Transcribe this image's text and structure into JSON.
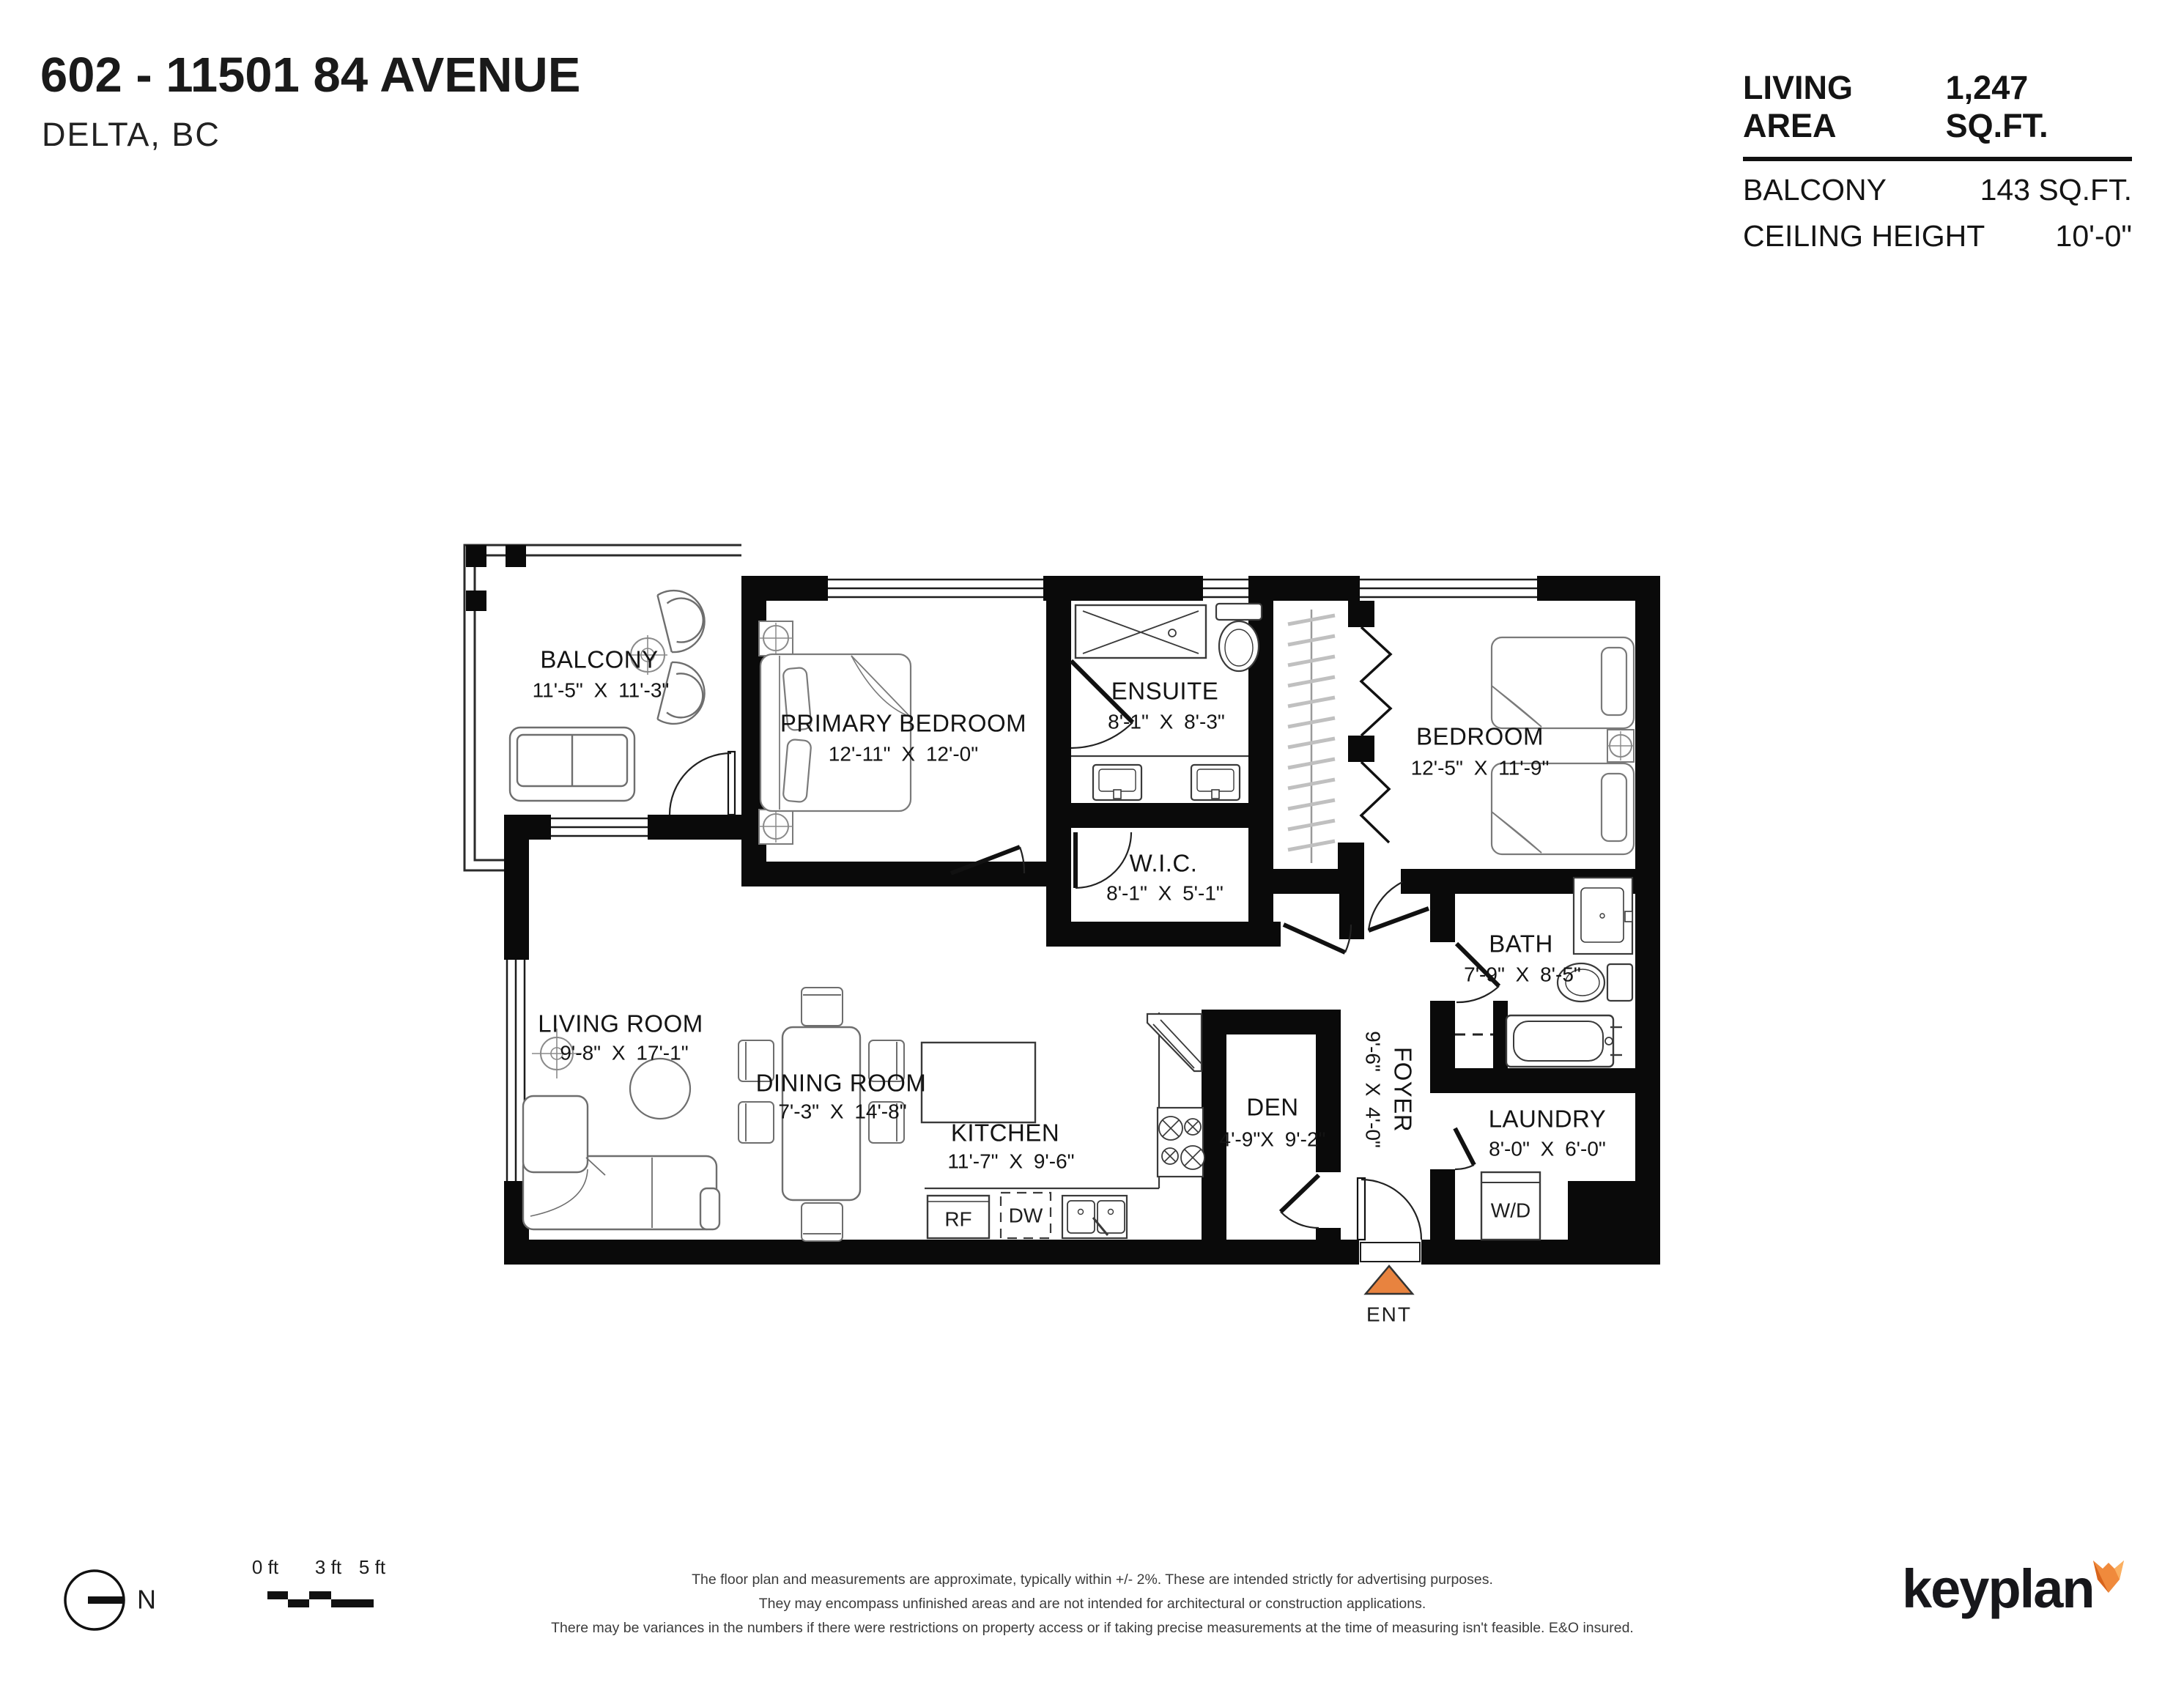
{
  "header": {
    "title": "602 - 11501 84 AVENUE",
    "subtitle": "DELTA, BC"
  },
  "stats": {
    "rows": [
      {
        "label": "LIVING AREA",
        "value": "1,247 SQ.FT."
      },
      {
        "label": "BALCONY",
        "value": "143 SQ.FT."
      },
      {
        "label": "CEILING HEIGHT",
        "value": "10'-0\""
      }
    ]
  },
  "rooms": {
    "balcony": {
      "name": "BALCONY",
      "dims": "11'-5\" X 11'-3\""
    },
    "primary_bedroom": {
      "name": "PRIMARY BEDROOM",
      "dims": "12'-11\" X 12'-0\""
    },
    "ensuite": {
      "name": "ENSUITE",
      "dims": "8'-1\" X 8'-3\""
    },
    "wic": {
      "name": "W.I.C.",
      "dims": "8'-1\" X 5'-1\""
    },
    "bedroom": {
      "name": "BEDROOM",
      "dims": "12'-5\" X 11'-9\""
    },
    "bath": {
      "name": "BATH",
      "dims": "7'-9\" X 8'-5\""
    },
    "laundry": {
      "name": "LAUNDRY",
      "dims": "8'-0\" X 6'-0\""
    },
    "living_room": {
      "name": "LIVING ROOM",
      "dims": "9'-8\" X 17'-1\""
    },
    "dining_room": {
      "name": "DINING ROOM",
      "dims": "7'-3\" X 14'-8\""
    },
    "kitchen": {
      "name": "KITCHEN",
      "dims": "11'-7\" X 9'-6\""
    },
    "den": {
      "name": "DEN",
      "dims": "4'-9\"X 9'-2\""
    },
    "foyer": {
      "name": "FOYER",
      "dims": "9'-6\" X 4'-0\""
    }
  },
  "fixtures": {
    "fridge": "RF",
    "dishwasher": "DW",
    "washer_dryer": "W/D"
  },
  "entry": {
    "label": "ENT"
  },
  "north": {
    "label": "N"
  },
  "scale_bar": {
    "ticks": [
      "0 ft",
      "3 ft",
      "5 ft"
    ]
  },
  "disclaimer": {
    "line1": "The floor plan and measurements are approximate, typically within +/- 2%. These are intended strictly for advertising purposes.",
    "line2": "They may encompass unfinished areas and are not intended for architectural or construction applications.",
    "line3": "There may be variances in the numbers if there were restrictions on property access or if taking precise measurements at the time of measuring isn't feasible. E&O insured."
  },
  "brand": {
    "name": "keyplan"
  },
  "colors": {
    "accent_orange": "#E8833F",
    "wall_black": "#0a0a0a"
  }
}
